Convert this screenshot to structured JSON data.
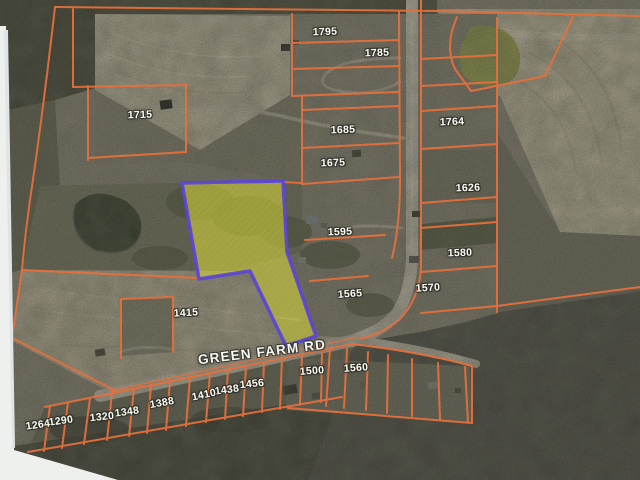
{
  "map": {
    "road_label": "GREEN FARM RD",
    "road_label_pos": {
      "x": 262,
      "y": 352,
      "angle": -7
    },
    "colors": {
      "parcel_line": "#e5703c",
      "highlight_stroke": "#5b44d8",
      "highlight_fill": "#e6e63c",
      "label_text": "#fdfdf2"
    },
    "parcel_labels": [
      {
        "text": "1795",
        "x": 325,
        "y": 32,
        "angle": -2
      },
      {
        "text": "1785",
        "x": 377,
        "y": 53,
        "angle": -2
      },
      {
        "text": "1715",
        "x": 140,
        "y": 115,
        "angle": -2
      },
      {
        "text": "1685",
        "x": 343,
        "y": 130,
        "angle": -2
      },
      {
        "text": "1675",
        "x": 333,
        "y": 163,
        "angle": -2
      },
      {
        "text": "1764",
        "x": 452,
        "y": 122,
        "angle": -2
      },
      {
        "text": "1626",
        "x": 468,
        "y": 188,
        "angle": -2
      },
      {
        "text": "1595",
        "x": 340,
        "y": 232,
        "angle": -2
      },
      {
        "text": "1580",
        "x": 460,
        "y": 253,
        "angle": -2
      },
      {
        "text": "1570",
        "x": 428,
        "y": 288,
        "angle": -3
      },
      {
        "text": "1565",
        "x": 350,
        "y": 294,
        "angle": -4
      },
      {
        "text": "1415",
        "x": 186,
        "y": 313,
        "angle": -3
      },
      {
        "text": "1500",
        "x": 312,
        "y": 371,
        "angle": -4
      },
      {
        "text": "1560",
        "x": 356,
        "y": 368,
        "angle": -4
      },
      {
        "text": "1456",
        "x": 252,
        "y": 384,
        "angle": -6
      },
      {
        "text": "1438",
        "x": 227,
        "y": 390,
        "angle": -8
      },
      {
        "text": "1410",
        "x": 204,
        "y": 395,
        "angle": -12
      },
      {
        "text": "1388",
        "x": 162,
        "y": 403,
        "angle": -10
      },
      {
        "text": "1348",
        "x": 127,
        "y": 412,
        "angle": -8
      },
      {
        "text": "1320",
        "x": 102,
        "y": 417,
        "angle": -6
      },
      {
        "text": "1290",
        "x": 61,
        "y": 421,
        "angle": -8
      },
      {
        "text": "1264",
        "x": 38,
        "y": 425,
        "angle": -8
      }
    ]
  }
}
